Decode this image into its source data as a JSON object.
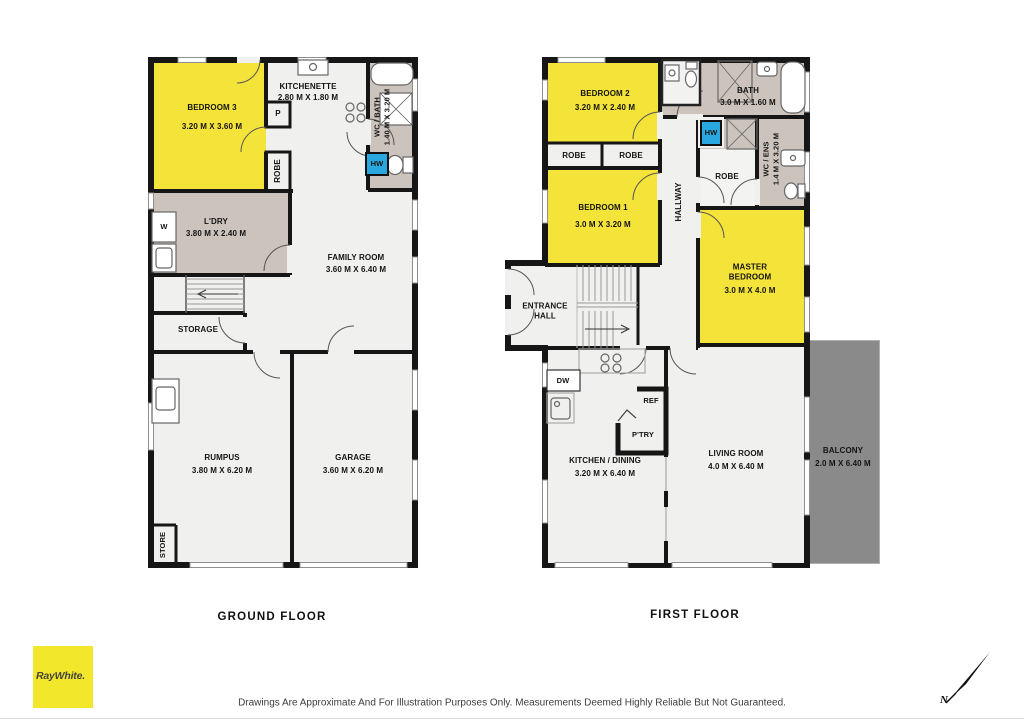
{
  "colors": {
    "room_yellow": "#F4E339",
    "wet_area_taupe": "#CBC3BC",
    "floor_white": "#F0F0EE",
    "balcony_gray": "#8A8A8A",
    "hot_water_blue": "#29A8E0",
    "wall_black": "#161616",
    "brand_yellow": "#F3E72C"
  },
  "floors": [
    {
      "caption": "GROUND FLOOR",
      "rooms": {
        "bedroom3": {
          "name": "BEDROOM 3",
          "dims": "3.20 M X 3.60 M"
        },
        "kitchenette": {
          "name": "KITCHENETTE",
          "dims": "2.80 M X 1.80 M"
        },
        "pantry": {
          "name": "P"
        },
        "robe": {
          "name": "ROBE"
        },
        "wc_bath": {
          "name": "WC / BATH",
          "dims": "1.40 M X 3.20 M"
        },
        "hw": {
          "name": "HW"
        },
        "laundry": {
          "name": "L'DRY",
          "dims": "3.80 M X 2.40 M"
        },
        "washer": {
          "name": "W"
        },
        "family": {
          "name": "FAMILY ROOM",
          "dims": "3.60 M X 6.40 M"
        },
        "storage": {
          "name": "STORAGE"
        },
        "rumpus": {
          "name": "RUMPUS",
          "dims": "3.80 M X 6.20 M"
        },
        "garage": {
          "name": "GARAGE",
          "dims": "3.60 M X 6.20 M"
        },
        "store": {
          "name": "STORE"
        }
      }
    },
    {
      "caption": "FIRST FLOOR",
      "rooms": {
        "bedroom2": {
          "name": "BEDROOM 2",
          "dims": "3.20 M X 2.40 M"
        },
        "robe_a": {
          "name": "ROBE"
        },
        "robe_b": {
          "name": "ROBE"
        },
        "bath": {
          "name": "BATH",
          "dims": "3.0 M X 1.60 M"
        },
        "hw": {
          "name": "HW"
        },
        "wc_ens": {
          "name": "WC / ENS",
          "dims": "1.4 M X 3.20 M"
        },
        "robe_master": {
          "name": "ROBE"
        },
        "bedroom1": {
          "name": "BEDROOM 1",
          "dims": "3.0 M X 3.20 M"
        },
        "hallway": {
          "name": "HALLWAY"
        },
        "master": {
          "name": "MASTER BEDROOM",
          "dims": "3.0 M X 4.0 M"
        },
        "entrance": {
          "name": "ENTRANCE HALL"
        },
        "kitchen": {
          "name": "KITCHEN / DINING",
          "dims": "3.20 M X 6.40 M"
        },
        "dw": {
          "name": "DW"
        },
        "ref": {
          "name": "REF"
        },
        "ptry": {
          "name": "P'TRY"
        },
        "living": {
          "name": "LIVING ROOM",
          "dims": "4.0 M X 6.40 M"
        },
        "balcony": {
          "name": "BALCONY",
          "dims": "2.0 M X 6.40 M"
        }
      }
    }
  ],
  "footer": {
    "brand": "RayWhite.",
    "disclaimer": "Drawings Are Approximate And For Illustration Purposes Only. Measurements Deemed Highly Reliable But Not Guaranteed.",
    "north": "N"
  }
}
